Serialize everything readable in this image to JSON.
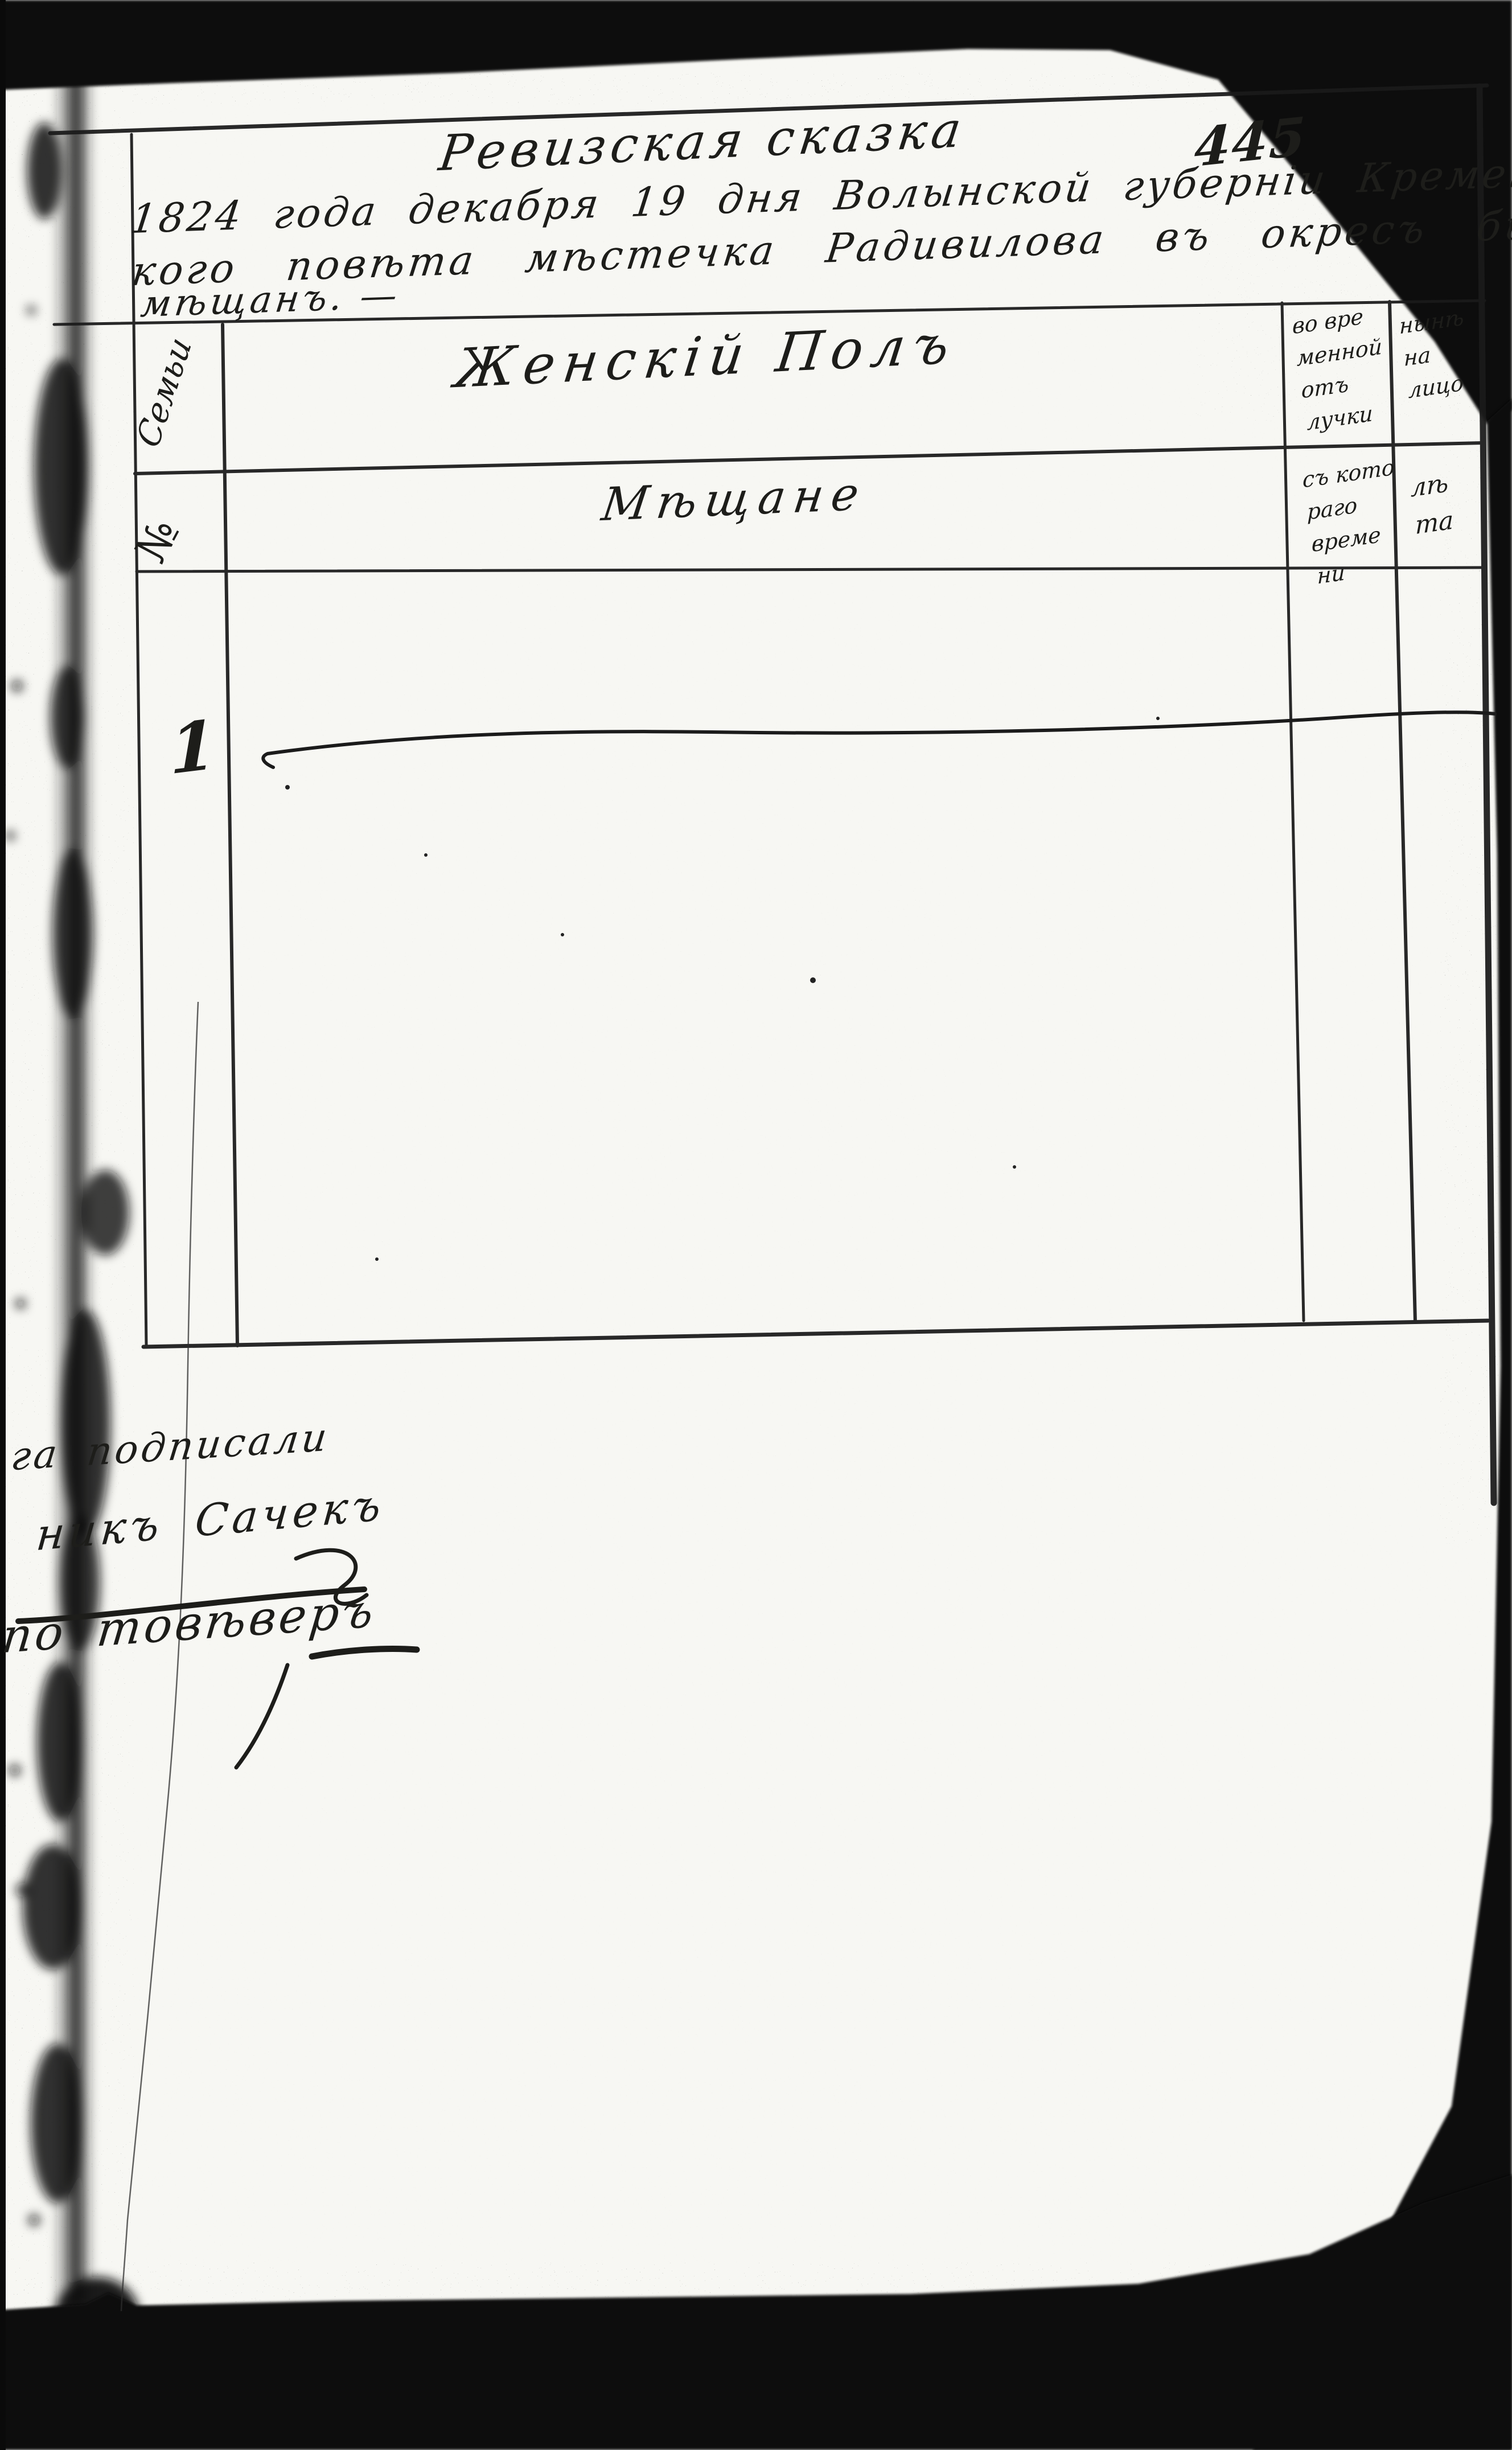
{
  "document": {
    "type_label": "Ревизская сказка",
    "page_number": "445",
    "header_lines": [
      "1824 года декабря 19 дня Волынской губерніи Кременец",
      "кого повѣта мѣстечка Радивилова въ окресъ бы",
      "мѣщанъ. —"
    ]
  },
  "table": {
    "family_column_label": "Семьи",
    "family_number_symbol": "№",
    "sex_section_header": "Женскій Полъ",
    "estate_header": "Мѣщане",
    "columns": {
      "absence": {
        "row1_lines": [
          "во вре",
          "менной",
          "отъ",
          "лучки"
        ],
        "row2_lines": [
          "съ кото",
          "раго",
          "време",
          "ни"
        ]
      },
      "present": {
        "row1_lines": [
          "нынѣ",
          "на",
          "лицо"
        ],
        "row2_lines": [
          "лѣ",
          "та"
        ]
      }
    },
    "entries": [
      {
        "number": "1",
        "value": "—"
      }
    ]
  },
  "signature_block": {
    "lines": [
      "га подписали",
      "никъ Сачекъ",
      "по товѣверъ"
    ]
  }
}
